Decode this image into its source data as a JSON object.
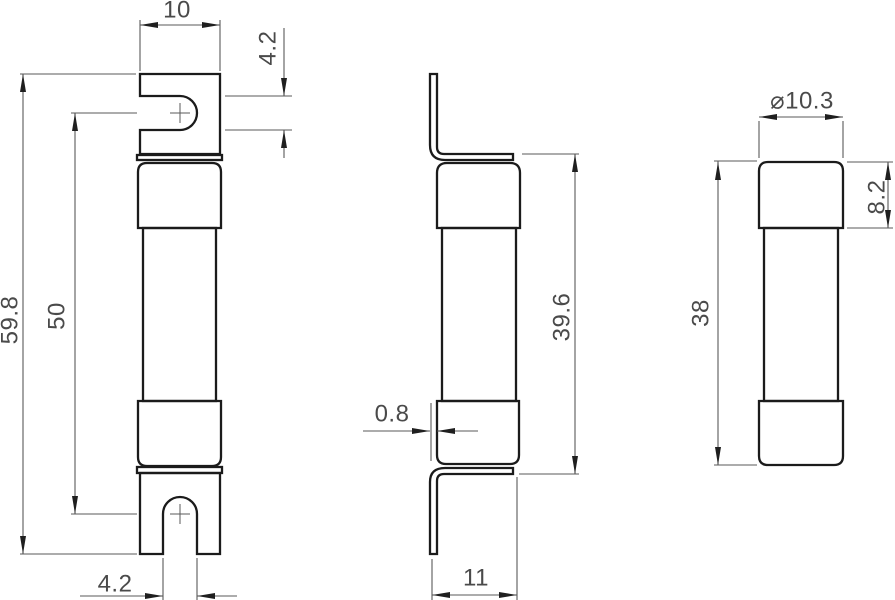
{
  "colors": {
    "background": "#ffffff",
    "object_line": "#1b1b1b",
    "dimension_line": "#5a5a5a",
    "arrowhead": "#1f1f1f",
    "text": "#4a4a4a"
  },
  "views": {
    "front": {
      "dims": {
        "width": "10",
        "slot_top": "4.2",
        "overall_length": "59.8",
        "slot_centers": "50",
        "slot_bottom": "4.2"
      }
    },
    "side": {
      "dims": {
        "blade_thickness": "0.8",
        "blade_span": "39.6",
        "depth": "11"
      }
    },
    "body": {
      "dims": {
        "diameter": "⌀10.3",
        "cap_length": "8.2",
        "body_length": "38"
      }
    }
  }
}
